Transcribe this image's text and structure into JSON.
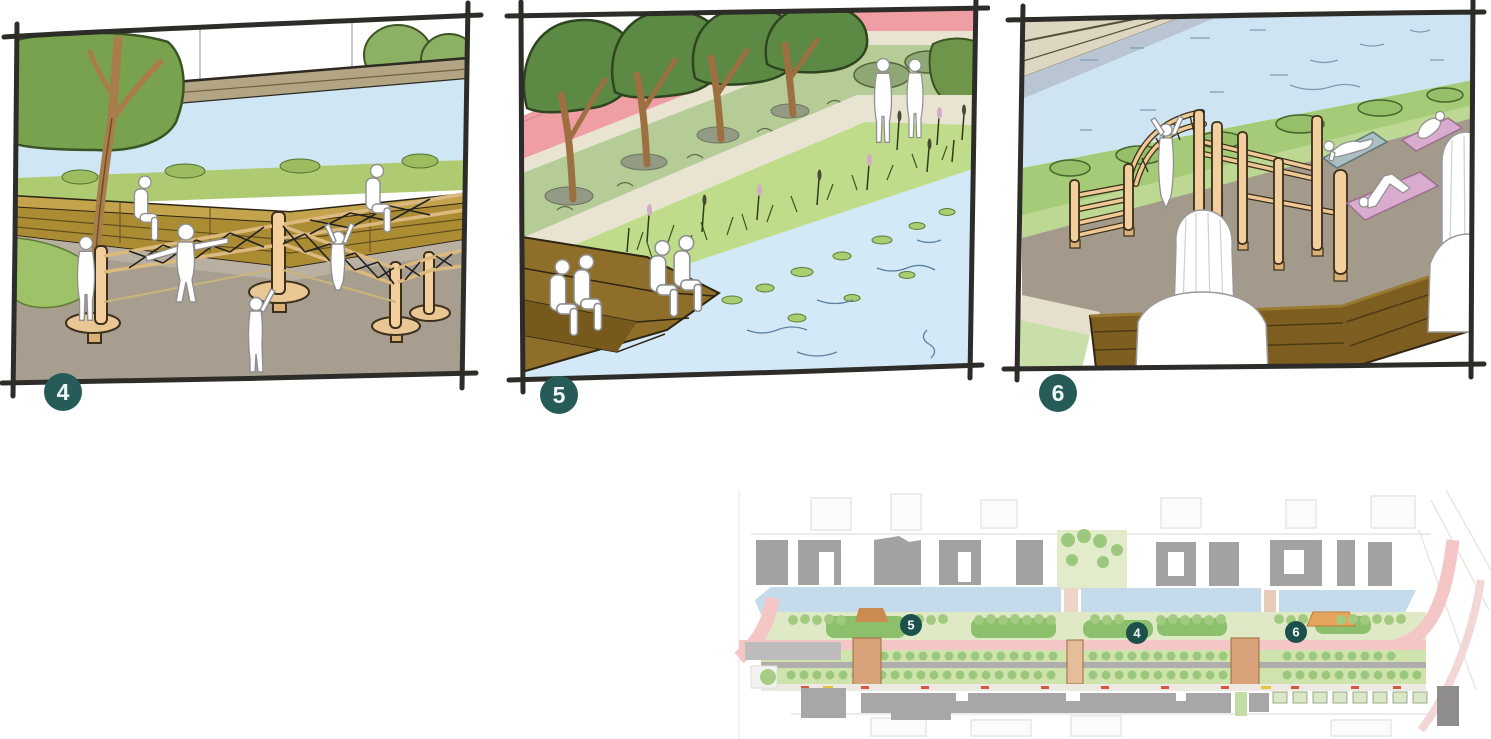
{
  "sketch_panels": [
    {
      "number": "4",
      "badge_color": "#265b57"
    },
    {
      "number": "5",
      "badge_color": "#265b57"
    },
    {
      "number": "6",
      "badge_color": "#265b57"
    }
  ],
  "site_plan": {
    "markers": [
      {
        "number": "5"
      },
      {
        "number": "4"
      },
      {
        "number": "6"
      }
    ],
    "marker_color": "#1d4f4b"
  },
  "palette": {
    "sketch_line": "#2e2c28",
    "water": "#cfe6f4",
    "bank_grass": "#a5cb79",
    "tree_canopy": "#5c8a44",
    "timber_deck": "#8f6e2a",
    "timber_wall": "#ab8c33",
    "post_tan": "#f2cf9e",
    "ground_taupe": "#a39a8b",
    "path_pink": "#ef9fa4",
    "path_beige": "#e9e3d2",
    "reed_green": "#bedc8a",
    "yoga_mat_blue": "#a9bfc1",
    "yoga_mat_pink": "#d9abce",
    "plan_canal": "#c5daea",
    "plan_building": "#a3a1a2",
    "plan_road_pink": "#f5c6c6",
    "plan_median_green": "#cde3ad",
    "plan_lawn_green": "#8cc06d"
  }
}
